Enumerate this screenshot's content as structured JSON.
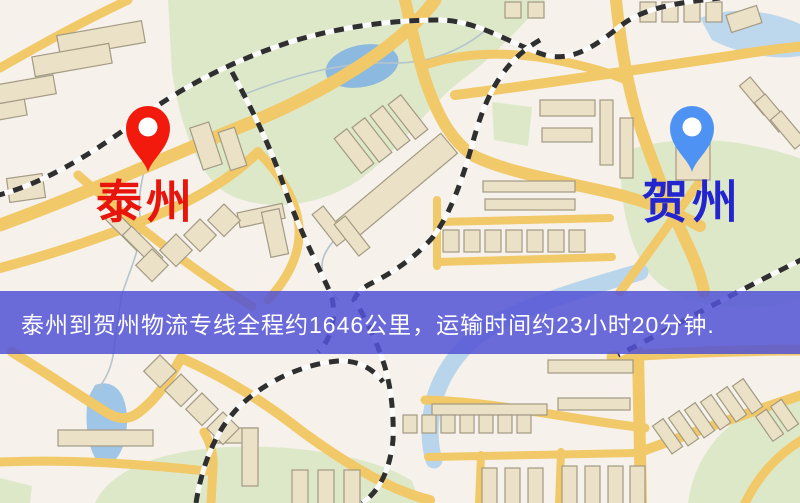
{
  "map": {
    "origin": {
      "label": "泰州",
      "label_color": "#e8150c",
      "pin_color": "#f21a0c"
    },
    "destination": {
      "label": "贺州",
      "label_color": "#2325cf",
      "pin_color": "#4e92f3"
    },
    "banner": {
      "text": "泰州到贺州物流专线全程约1646公里，运输时间约23小时20分钟.",
      "background": "rgba(82,82,214,0.85)",
      "text_color": "#ffffff"
    },
    "colors": {
      "land": "#f6f1ea",
      "park": "#dde8c9",
      "water": "#8bb9df",
      "road": "#f1c968",
      "railway": "#2f2f2f",
      "building": "#ebe1c6"
    }
  }
}
